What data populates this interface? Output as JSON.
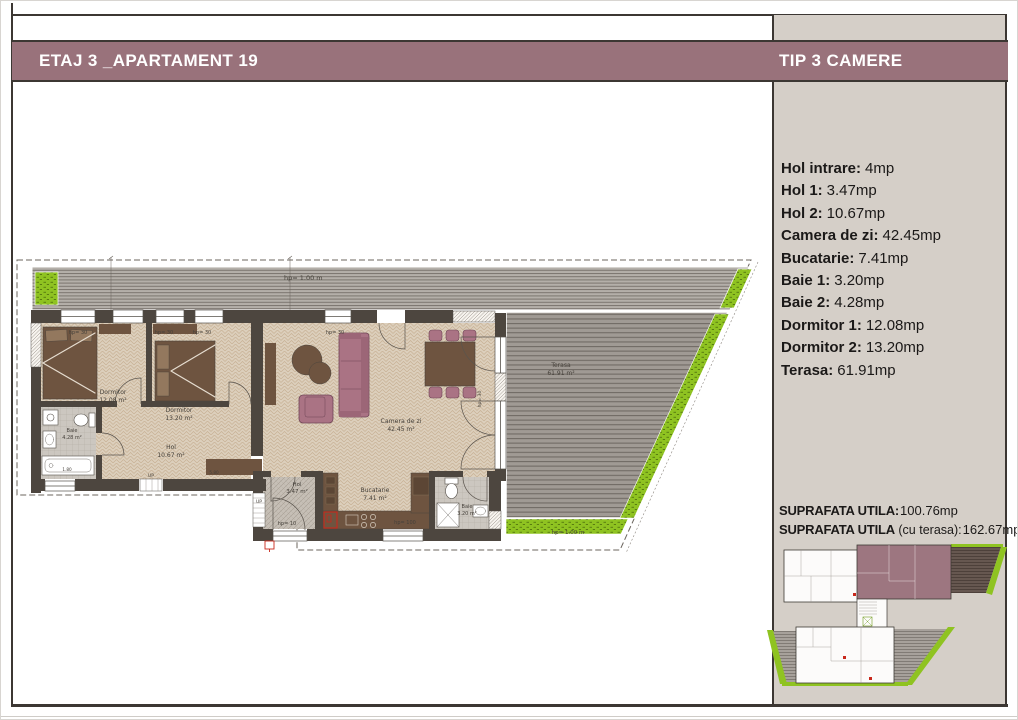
{
  "header": {
    "title": "ETAJ 3 _APARTAMENT 19",
    "type_label": "TIP 3 CAMERE",
    "bar_color": "#99727b",
    "text_color": "#ffffff",
    "frame_color": "#3c3733"
  },
  "sidebar": {
    "bg_color": "#d5cfc8",
    "rooms": [
      {
        "label": "Hol intrare:",
        "value": "4mp"
      },
      {
        "label": "Hol 1:",
        "value": "3.47mp"
      },
      {
        "label": "Hol 2:",
        "value": "10.67mp"
      },
      {
        "label": "Camera de zi:",
        "value": "42.45mp"
      },
      {
        "label": "Bucatarie:",
        "value": "7.41mp"
      },
      {
        "label": "Baie 1:",
        "value": "3.20mp"
      },
      {
        "label": "Baie 2:",
        "value": "4.28mp"
      },
      {
        "label": "Dormitor 1:",
        "value": "12.08mp"
      },
      {
        "label": "Dormitor 2:",
        "value": "13.20mp"
      },
      {
        "label": "Terasa:",
        "value": "61.91mp"
      }
    ],
    "totals": [
      {
        "label": "SUPRAFATA UTILA:",
        "suffix": "",
        "value": "100.76mp"
      },
      {
        "label": "SUPRAFATA UTILA",
        "suffix": " (cu terasa):",
        "value": "162.67mp"
      }
    ]
  },
  "plan": {
    "colors": {
      "wall": "#4d463f",
      "floor": "#dccfbc",
      "furniture_wood": "#6e5440",
      "furniture_mauve": "#aa7384",
      "deck": "#a09a94",
      "green": "#8fc321",
      "red_accent": "#c8281c"
    },
    "labels": {
      "band_hp": "hp= 1.00 m",
      "green_hp": "hp= 1.00 m",
      "hp30": "hp= 30",
      "hp10": "hp= 10",
      "hp100": "hp= 100",
      "up": "UP",
      "dim_tub": "1.80",
      "dim_hall": "5.80",
      "dormitor1": "Dormitor",
      "dormitor1_area": "12.08 m²",
      "dormitor2": "Dormitor",
      "dormitor2_area": "13.20 m²",
      "baie1": "Baie",
      "baie1_area": "4.28 m²",
      "baie2": "Baie",
      "baie2_area": "3.20 m²",
      "hol1": "Hol",
      "hol1_area": "3.47 m²",
      "hol2": "Hol",
      "hol2_area": "10.67 m²",
      "camera": "Camera de zi",
      "camera_area": "42.45 m²",
      "bucatarie": "Bucatarie",
      "bucatarie_area": "7.41 m²",
      "terasa": "Terasa",
      "terasa_area": "61.91 m²"
    }
  },
  "minimap": {
    "highlight_color": "#9d7680",
    "description": "key plan of floor with current apartment highlighted"
  }
}
